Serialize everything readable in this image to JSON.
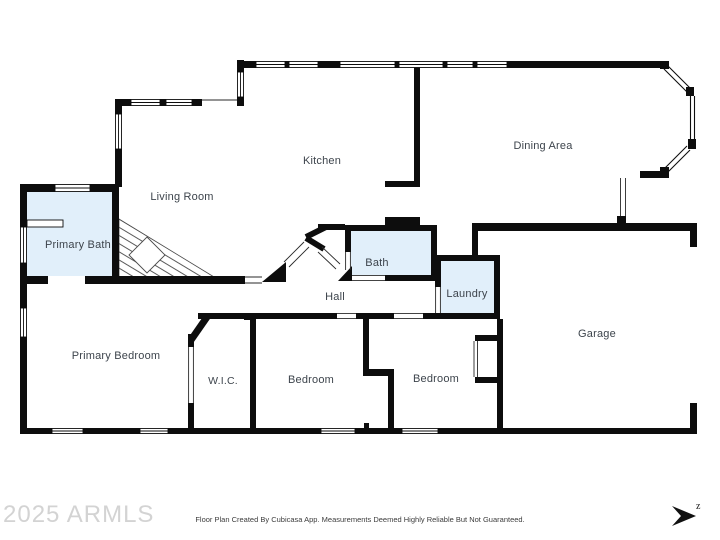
{
  "rooms": {
    "living_room": "Living Room",
    "kitchen": "Kitchen",
    "dining_area": "Dining Area",
    "primary_bath": "Primary Bath",
    "bath": "Bath",
    "laundry": "Laundry",
    "hall": "Hall",
    "primary_bedroom": "Primary Bedroom",
    "wic": "W.I.C.",
    "bedroom_left": "Bedroom",
    "bedroom_right": "Bedroom",
    "garage": "Garage"
  },
  "watermark": "2025 ARMLS",
  "footer": "Floor Plan Created By Cubicasa App. Measurements Deemed Highly Reliable But Not Guaranteed.",
  "compass": {
    "label": "z"
  },
  "colors": {
    "wall": "#0d0d0d",
    "wet_room_fill": "#e1effa",
    "label_text": "#3d444c",
    "watermark_text": "#d3d3d3"
  }
}
